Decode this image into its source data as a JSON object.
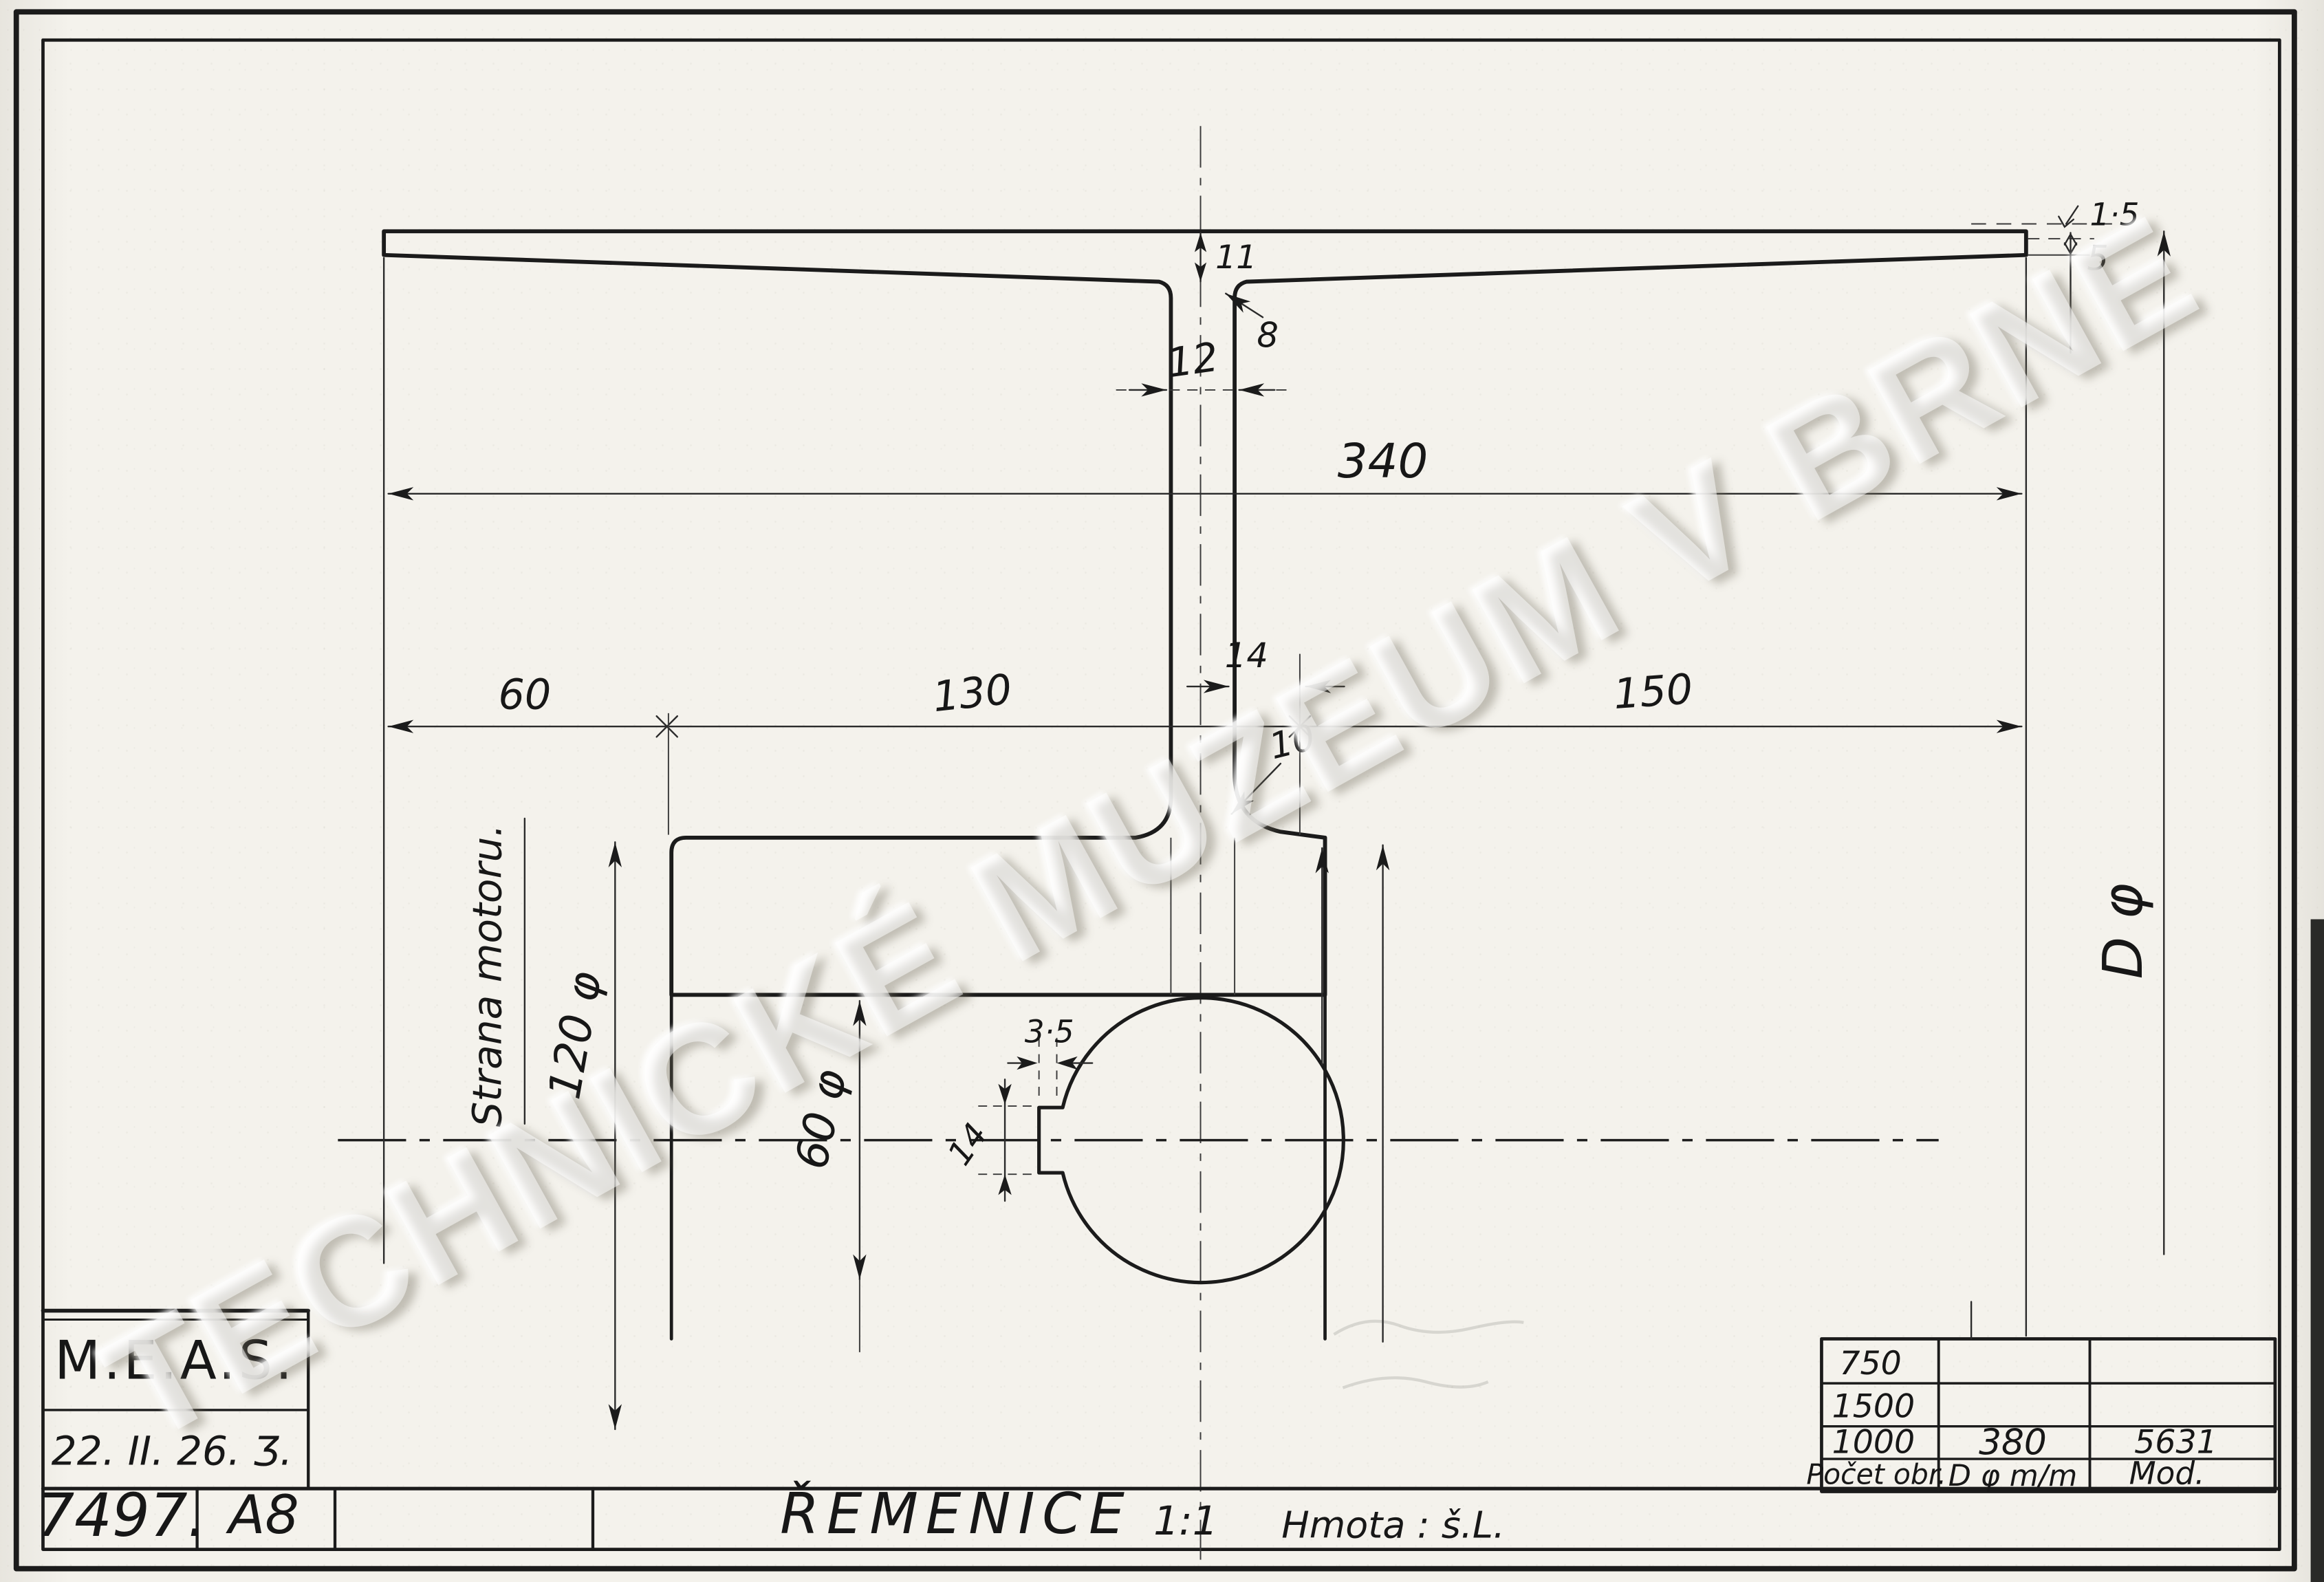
{
  "watermark": {
    "text": "TECHNICKÉ MUZEUM V BRNE"
  },
  "title_block": {
    "company": "M.E.A.S.",
    "date": "22. II. 26. Ʒ.",
    "drawing_number": "7497.",
    "sheet_code": "A8",
    "part_title": "ŘEMENICE",
    "scale": "1:1",
    "material": "Hmota : š.L."
  },
  "revision_table": {
    "r1c1": "750",
    "r2c1": "1500",
    "r3c1": "1000",
    "r3c2": "380",
    "r3c3": "5631",
    "h1": "Počet obr.",
    "h2": "D φ m/m",
    "h3": "Mod."
  },
  "dims": {
    "face_width": "340",
    "hub_left_offset": "60",
    "web_to_hub": "130",
    "right_span": "150",
    "web_bottom": "14",
    "web_top": "12",
    "rim_center_thk": "11",
    "fillet_top": "8",
    "fillet_bottom": "10",
    "hub_dia": "120 φ",
    "bore_dia": "60 φ",
    "crown": "1·5",
    "rim_edge_thk": "5",
    "key_depth": "3·5",
    "key_width": "14",
    "outer_dia": "D φ"
  },
  "notes": {
    "motor_side": "Strana motoru."
  }
}
